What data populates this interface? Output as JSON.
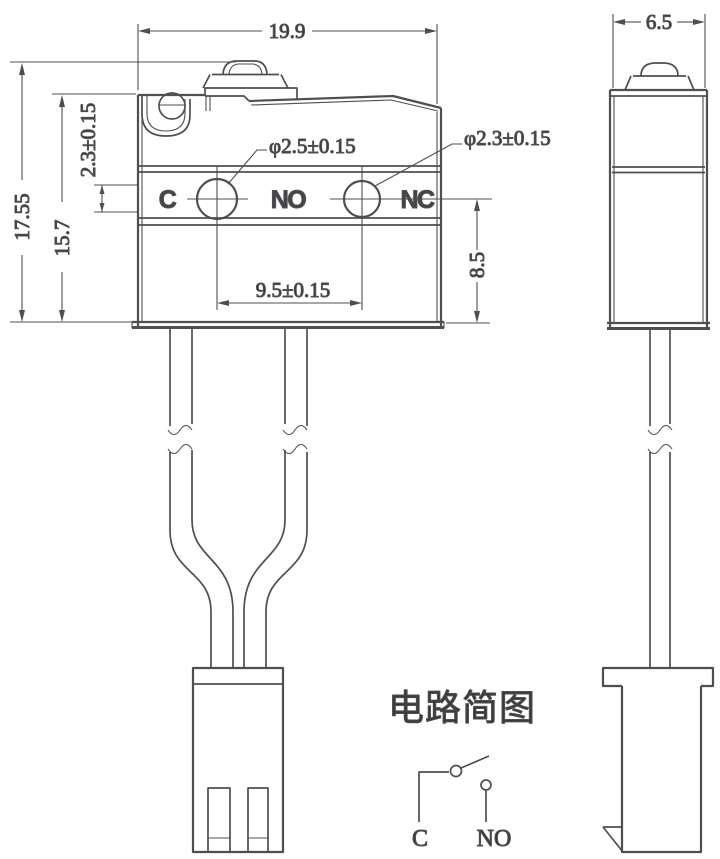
{
  "front_view": {
    "terminals": [
      "C",
      "NO",
      "NC"
    ],
    "hole1_diameter": "φ2.5±0.15",
    "hole2_diameter": "φ2.3±0.15"
  },
  "dimensions": {
    "overall_width": "19.9",
    "overall_height": "17.55",
    "body_height": "15.7",
    "hole_center_offset": "2.3±0.15",
    "hole_spacing": "9.5±0.15",
    "terminal_row_to_bottom": "8.5",
    "side_width": "6.5"
  },
  "circuit": {
    "title": "电路简图",
    "labels": [
      "C",
      "NO"
    ]
  },
  "colors": {
    "line": "#4f4f52",
    "text": "#3b3b3e",
    "background": "#ffffff"
  }
}
